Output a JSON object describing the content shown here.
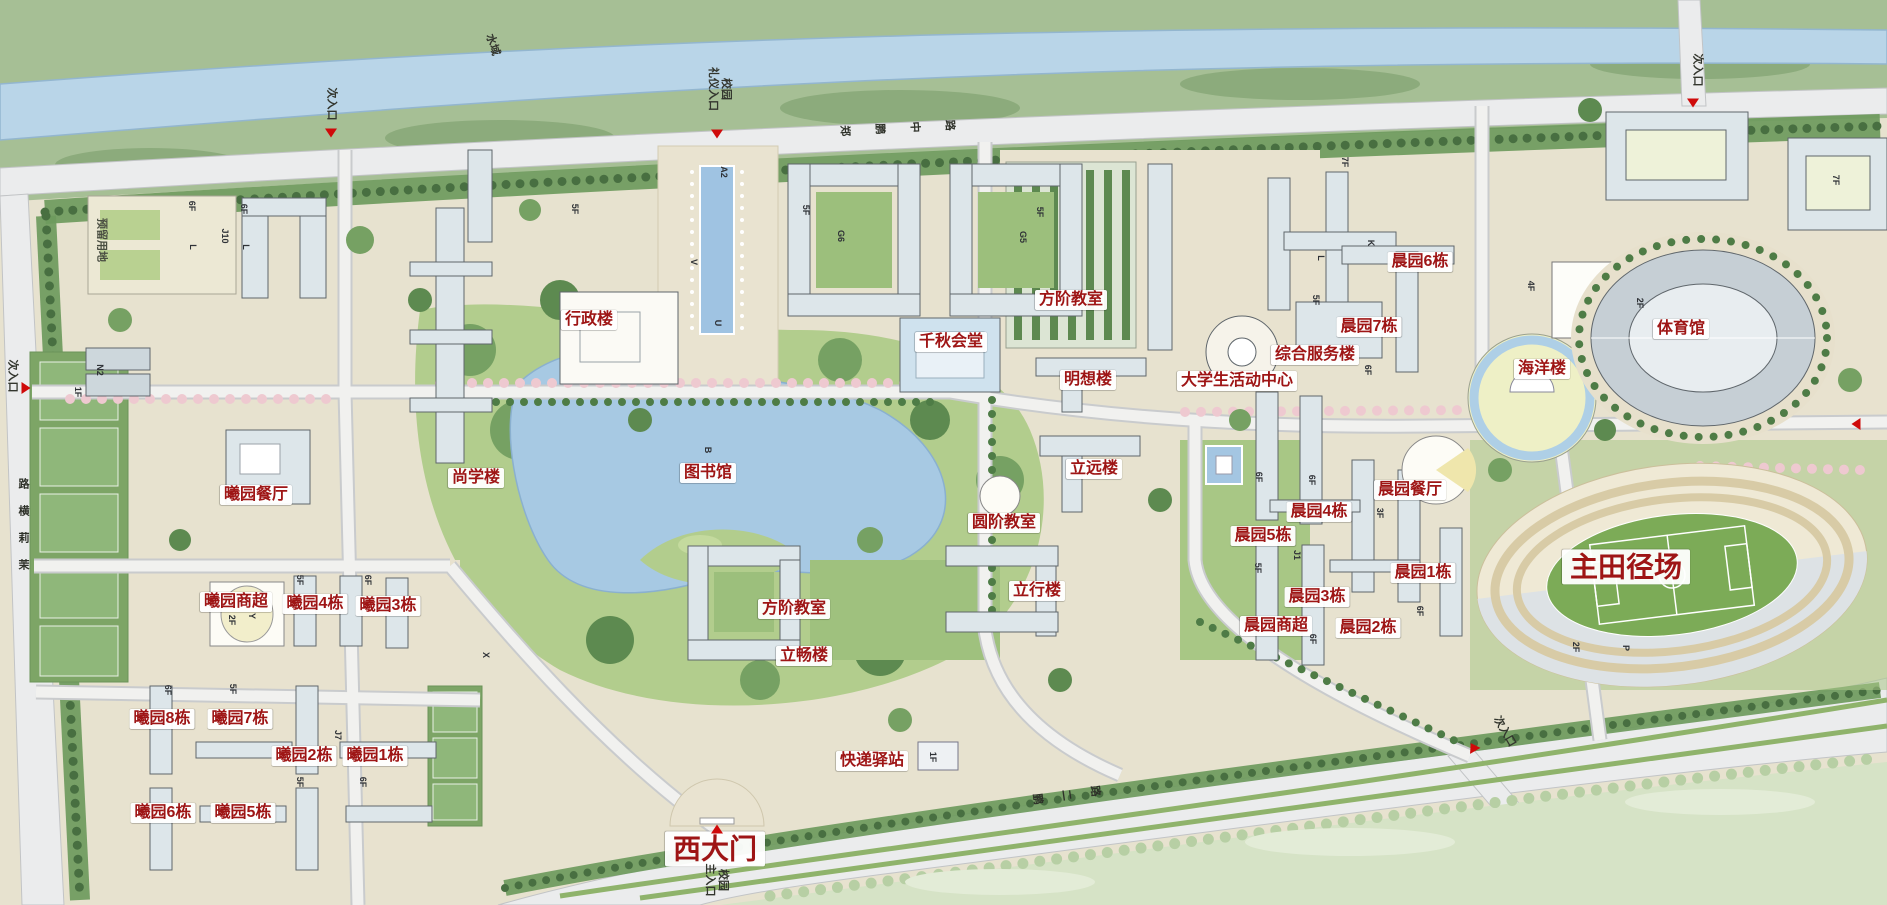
{
  "meta": {
    "description": "campus master plan map"
  },
  "colors": {
    "label_red": "#9e1515",
    "river_blue": "#b9d5e8",
    "lake_blue": "#a7c9e3",
    "road_gray": "#ebeced",
    "park_green": "#b2cd8d",
    "tree_dark_green": "#5d8a50",
    "blossom_pink": "#eec9d0",
    "field_green": "#7cab57"
  },
  "labels": {
    "buildings": [
      {
        "t": "行政楼",
        "x": 589,
        "y": 320
      },
      {
        "t": "尚学楼",
        "x": 476,
        "y": 478
      },
      {
        "t": "图书馆",
        "x": 708,
        "y": 473
      },
      {
        "t": "曦园餐厅",
        "x": 256,
        "y": 495
      },
      {
        "t": "千秋会堂",
        "x": 951,
        "y": 342
      },
      {
        "t": "方阶教室",
        "x": 1071,
        "y": 300
      },
      {
        "t": "明想楼",
        "x": 1088,
        "y": 380
      },
      {
        "t": "大学生活动中心",
        "x": 1237,
        "y": 381
      },
      {
        "t": "综合服务楼",
        "x": 1315,
        "y": 355
      },
      {
        "t": "晨园7栋",
        "x": 1369,
        "y": 327
      },
      {
        "t": "晨园6栋",
        "x": 1420,
        "y": 262
      },
      {
        "t": "海洋楼",
        "x": 1542,
        "y": 369
      },
      {
        "t": "体育馆",
        "x": 1681,
        "y": 329
      },
      {
        "t": "立远楼",
        "x": 1094,
        "y": 469
      },
      {
        "t": "圆阶教室",
        "x": 1004,
        "y": 523
      },
      {
        "t": "立行楼",
        "x": 1037,
        "y": 591
      },
      {
        "t": "方阶教室",
        "x": 794,
        "y": 609
      },
      {
        "t": "立畅楼",
        "x": 804,
        "y": 656
      },
      {
        "t": "快递驿站",
        "x": 872,
        "y": 761
      },
      {
        "t": "晨园餐厅",
        "x": 1410,
        "y": 490
      },
      {
        "t": "晨园4栋",
        "x": 1319,
        "y": 512
      },
      {
        "t": "晨园5栋",
        "x": 1263,
        "y": 536
      },
      {
        "t": "晨园1栋",
        "x": 1423,
        "y": 573
      },
      {
        "t": "晨园3栋",
        "x": 1317,
        "y": 597
      },
      {
        "t": "晨园商超",
        "x": 1276,
        "y": 626
      },
      {
        "t": "晨园2栋",
        "x": 1368,
        "y": 628
      },
      {
        "t": "主田径场",
        "x": 1626,
        "y": 567,
        "s": "lg"
      },
      {
        "t": "曦园商超",
        "x": 236,
        "y": 602
      },
      {
        "t": "曦园4栋",
        "x": 315,
        "y": 604
      },
      {
        "t": "曦园3栋",
        "x": 388,
        "y": 606
      },
      {
        "t": "曦园8栋",
        "x": 162,
        "y": 719
      },
      {
        "t": "曦园7栋",
        "x": 240,
        "y": 719
      },
      {
        "t": "曦园2栋",
        "x": 304,
        "y": 756
      },
      {
        "t": "曦园1栋",
        "x": 375,
        "y": 756
      },
      {
        "t": "曦园6栋",
        "x": 163,
        "y": 813
      },
      {
        "t": "曦园5栋",
        "x": 243,
        "y": 813
      },
      {
        "t": "西大门",
        "x": 715,
        "y": 849,
        "s": "lg"
      }
    ],
    "entrances": [
      {
        "t": "次入口",
        "x": 331,
        "y": 104,
        "r": 90
      },
      {
        "t": "次入口",
        "x": 1697,
        "y": 70,
        "r": 90
      },
      {
        "t": "次入口",
        "x": 12,
        "y": 376,
        "r": 90
      },
      {
        "t": "次入口",
        "x": 1504,
        "y": 732,
        "r": 60
      }
    ],
    "areas": [
      {
        "t": "水域",
        "x": 492,
        "y": 45,
        "r": 72
      },
      {
        "t": "预留用地",
        "x": 101,
        "y": 240,
        "r": 90,
        "gray": true
      },
      {
        "t": "校园\n礼仪入口",
        "x": 719,
        "y": 89,
        "r": 90
      },
      {
        "t": "校园\n主入口",
        "x": 716,
        "y": 880,
        "r": 90
      }
    ],
    "roads": [
      {
        "t": "郑鹏中路",
        "x": 898,
        "y": 128,
        "gap": 24,
        "r": -3
      },
      {
        "t": "鹏二路",
        "x": 1067,
        "y": 795,
        "gap": 18,
        "r": -8
      },
      {
        "t": "茉莉横路",
        "x": 24,
        "y": 524,
        "gap": 16,
        "r": -90
      }
    ],
    "codes": [
      {
        "t": "6F",
        "x": 192,
        "y": 206
      },
      {
        "t": "L",
        "x": 193,
        "y": 247
      },
      {
        "t": "6F",
        "x": 244,
        "y": 209
      },
      {
        "t": "L",
        "x": 246,
        "y": 247
      },
      {
        "t": "J10",
        "x": 225,
        "y": 236
      },
      {
        "t": "5F",
        "x": 575,
        "y": 209
      },
      {
        "t": "A2",
        "x": 724,
        "y": 172
      },
      {
        "t": "V",
        "x": 694,
        "y": 262
      },
      {
        "t": "U",
        "x": 718,
        "y": 323
      },
      {
        "t": "G6",
        "x": 841,
        "y": 236
      },
      {
        "t": "5F",
        "x": 806,
        "y": 210
      },
      {
        "t": "G5",
        "x": 1023,
        "y": 237
      },
      {
        "t": "5F",
        "x": 1040,
        "y": 212
      },
      {
        "t": "B",
        "x": 708,
        "y": 450
      },
      {
        "t": "N2",
        "x": 100,
        "y": 370
      },
      {
        "t": "1F",
        "x": 78,
        "y": 392
      },
      {
        "t": "2F",
        "x": 232,
        "y": 620
      },
      {
        "t": "Y",
        "x": 252,
        "y": 616
      },
      {
        "t": "5F",
        "x": 300,
        "y": 580
      },
      {
        "t": "6F",
        "x": 368,
        "y": 580
      },
      {
        "t": "6F",
        "x": 168,
        "y": 690
      },
      {
        "t": "5F",
        "x": 233,
        "y": 689
      },
      {
        "t": "J7",
        "x": 338,
        "y": 735
      },
      {
        "t": "5F",
        "x": 300,
        "y": 782
      },
      {
        "t": "6F",
        "x": 363,
        "y": 782
      },
      {
        "t": "X",
        "x": 486,
        "y": 655
      },
      {
        "t": "4F",
        "x": 1531,
        "y": 286
      },
      {
        "t": "2F",
        "x": 1640,
        "y": 303
      },
      {
        "t": "7F",
        "x": 1345,
        "y": 162
      },
      {
        "t": "7F",
        "x": 1836,
        "y": 180
      },
      {
        "t": "L",
        "x": 1321,
        "y": 258
      },
      {
        "t": "K",
        "x": 1371,
        "y": 243
      },
      {
        "t": "5F",
        "x": 1316,
        "y": 300
      },
      {
        "t": "6F",
        "x": 1368,
        "y": 370
      },
      {
        "t": "6F",
        "x": 1259,
        "y": 477
      },
      {
        "t": "6F",
        "x": 1312,
        "y": 480
      },
      {
        "t": "5F",
        "x": 1258,
        "y": 568
      },
      {
        "t": "J1",
        "x": 1297,
        "y": 555
      },
      {
        "t": "3F",
        "x": 1380,
        "y": 513
      },
      {
        "t": "6F",
        "x": 1420,
        "y": 611
      },
      {
        "t": "6F",
        "x": 1313,
        "y": 639
      },
      {
        "t": "2F",
        "x": 1576,
        "y": 647
      },
      {
        "t": "P",
        "x": 1626,
        "y": 648
      },
      {
        "t": "1F",
        "x": 933,
        "y": 757
      }
    ],
    "triangles": [
      {
        "x": 331,
        "y": 133,
        "d": 0
      },
      {
        "x": 717,
        "y": 134,
        "d": 0
      },
      {
        "x": 1693,
        "y": 103,
        "d": 0
      },
      {
        "x": 26,
        "y": 388,
        "d": -90
      },
      {
        "x": 1856,
        "y": 424,
        "d": 90
      },
      {
        "x": 717,
        "y": 829,
        "d": 180
      },
      {
        "x": 1473,
        "y": 747,
        "d": 150
      }
    ]
  }
}
